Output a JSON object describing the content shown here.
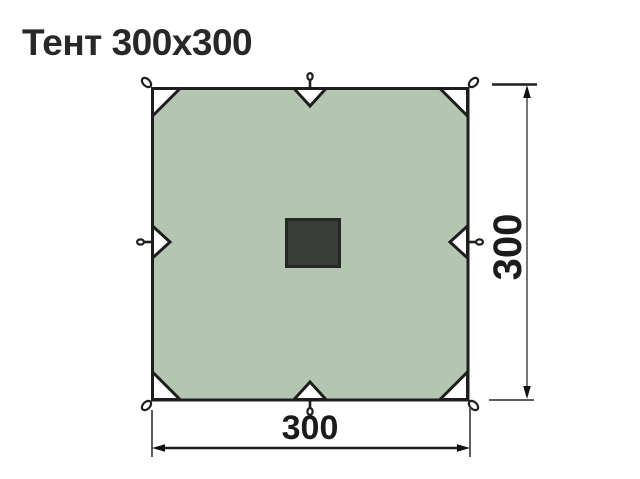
{
  "title": "Тент 300x300",
  "diagram": {
    "name": "tarp-dimension-drawing",
    "width_label": "300",
    "height_label": "300"
  },
  "colors": {
    "background": "#ffffff",
    "title_text": "#282828",
    "tarp_fill": "#b4c6b2",
    "outline": "#1e1e1c",
    "corner_patch_fill": "#ffffff",
    "center_patch_fill": "#383e37",
    "center_patch_border": "#242a23",
    "dimension_line": "#757575",
    "dimension_text": "#1b1b1b"
  }
}
